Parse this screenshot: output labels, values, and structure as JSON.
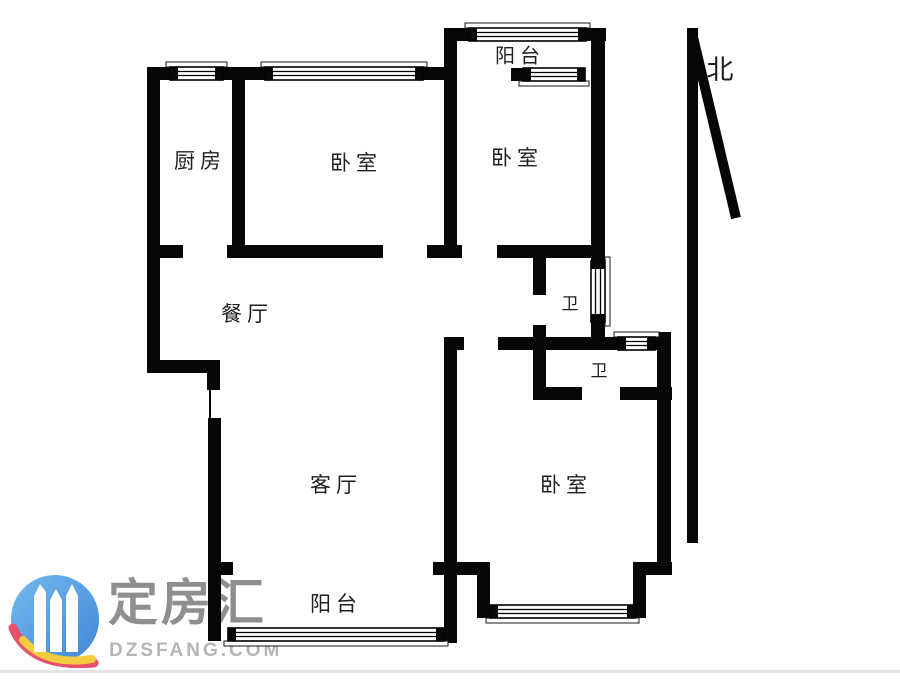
{
  "page": {
    "width": 900,
    "height": 679,
    "background": "#ffffff"
  },
  "north": {
    "label": "北"
  },
  "watermark": {
    "name": "定房汇",
    "domain": "DZSFANG.COM"
  },
  "colors": {
    "wall": "#060606",
    "label_text": "#1f1f1f",
    "window_stroke": "#1a1a1a",
    "watermark_name": "#8f8f8f",
    "watermark_domain": "#b5b5b5",
    "logo_blue_light": "#74b9ec",
    "logo_blue_dark": "#3f86d8",
    "logo_red": "#e8506b",
    "logo_yellow": "#f4ca3e",
    "bottom_border": "#e4e4e4"
  },
  "rooms": [
    {
      "label": "厨房",
      "x": 200,
      "y": 160,
      "size": 21
    },
    {
      "label": "卧室",
      "x": 356,
      "y": 162,
      "size": 21
    },
    {
      "label": "阳台",
      "x": 520,
      "y": 55,
      "size": 20
    },
    {
      "label": "卧室",
      "x": 517,
      "y": 157,
      "size": 21
    },
    {
      "label": "餐厅",
      "x": 247,
      "y": 313,
      "size": 21
    },
    {
      "label": "卫",
      "x": 570,
      "y": 303,
      "size": 17
    },
    {
      "label": "卫",
      "x": 599,
      "y": 370,
      "size": 17
    },
    {
      "label": "客厅",
      "x": 336,
      "y": 484,
      "size": 21
    },
    {
      "label": "卧室",
      "x": 566,
      "y": 484,
      "size": 21
    },
    {
      "label": "阳台",
      "x": 336,
      "y": 603,
      "size": 21
    }
  ],
  "floorplan": {
    "wall_thickness": 13,
    "walls": [
      [
        147,
        67,
        13,
        306
      ],
      [
        207,
        360,
        13,
        30
      ],
      [
        208,
        418,
        13,
        157
      ],
      [
        208,
        562,
        25,
        13
      ],
      [
        208,
        575,
        13,
        66
      ],
      [
        232,
        67,
        13,
        191
      ],
      [
        147,
        67,
        26,
        13
      ],
      [
        221,
        67,
        46,
        13
      ],
      [
        421,
        67,
        36,
        13
      ],
      [
        444,
        28,
        25,
        13
      ],
      [
        586,
        28,
        20,
        13
      ],
      [
        444,
        28,
        13,
        230
      ],
      [
        591,
        28,
        14,
        235
      ],
      [
        511,
        68,
        14,
        13
      ],
      [
        147,
        245,
        36,
        13
      ],
      [
        227,
        245,
        156,
        13
      ],
      [
        427,
        245,
        35,
        13
      ],
      [
        497,
        245,
        108,
        13
      ],
      [
        533,
        253,
        13,
        42
      ],
      [
        533,
        325,
        13,
        75
      ],
      [
        591,
        320,
        14,
        30
      ],
      [
        444,
        337,
        20,
        13
      ],
      [
        498,
        337,
        122,
        13
      ],
      [
        653,
        337,
        18,
        13
      ],
      [
        147,
        360,
        73,
        13
      ],
      [
        533,
        387,
        49,
        13
      ],
      [
        620,
        387,
        52,
        13
      ],
      [
        444,
        337,
        13,
        306
      ],
      [
        657,
        332,
        14,
        243
      ],
      [
        433,
        562,
        57,
        13
      ],
      [
        633,
        562,
        39,
        13
      ],
      [
        477,
        575,
        13,
        43
      ],
      [
        633,
        562,
        13,
        56
      ]
    ],
    "thin_walls": [
      [
        209,
        390,
        2,
        30
      ]
    ],
    "windows": [
      {
        "x": 170,
        "y": 67,
        "w": 53,
        "h": 13,
        "o": "h",
        "sill": "top"
      },
      {
        "x": 265,
        "y": 67,
        "w": 158,
        "h": 13,
        "o": "h",
        "sill": "top"
      },
      {
        "x": 469,
        "y": 28,
        "w": 117,
        "h": 13,
        "o": "h",
        "sill": "top"
      },
      {
        "x": 523,
        "y": 68,
        "w": 62,
        "h": 13,
        "o": "h",
        "sill": "bottom"
      },
      {
        "x": 591,
        "y": 261,
        "w": 14,
        "h": 61,
        "o": "v",
        "sill": "right"
      },
      {
        "x": 618,
        "y": 337,
        "w": 37,
        "h": 13,
        "o": "h",
        "sill": "top"
      },
      {
        "x": 490,
        "y": 605,
        "w": 145,
        "h": 13,
        "o": "h",
        "sill": "bottom"
      },
      {
        "x": 228,
        "y": 628,
        "w": 216,
        "h": 13,
        "o": "h",
        "sill": "bottom"
      }
    ],
    "north_arrow": {
      "bar": [
        687,
        28,
        11,
        515
      ],
      "slant": {
        "x1": 692,
        "y1": 33,
        "x2": 736,
        "y2": 218,
        "width": 10
      },
      "label_x": 720,
      "label_y": 79,
      "label_size": 27
    }
  }
}
